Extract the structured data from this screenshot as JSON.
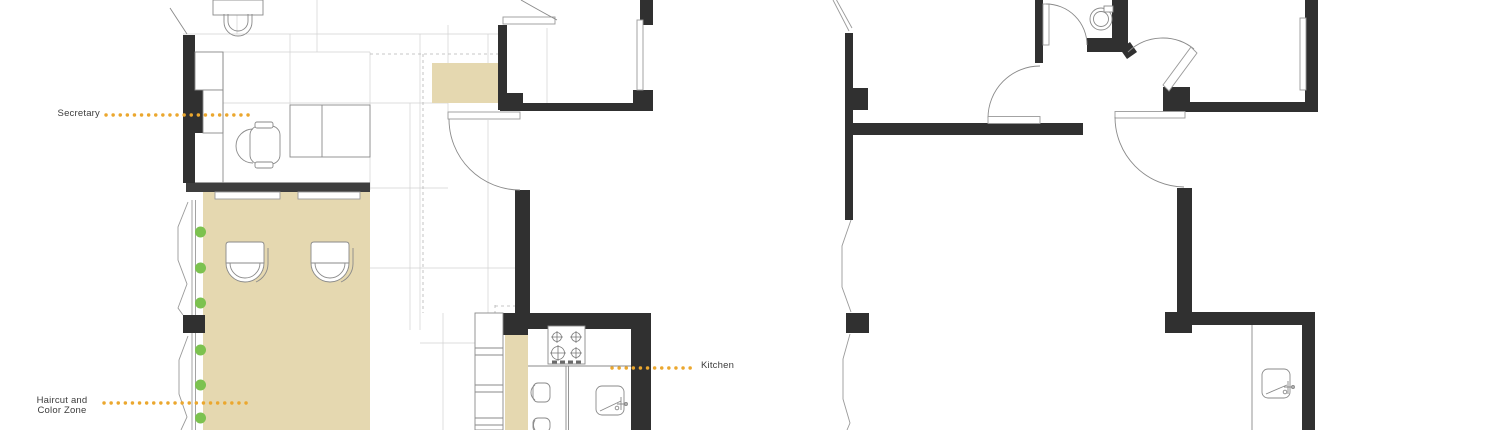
{
  "canvas": {
    "width": 1500,
    "height": 430,
    "background": "#ffffff"
  },
  "labels": {
    "secretary": {
      "text": "Secretary"
    },
    "haircut_color_zone": {
      "line1": "Haircut and",
      "line2": "Color Zone"
    },
    "kitchen": {
      "text": "Kitchen"
    }
  },
  "annotations": {
    "leader_line_style": "dotted",
    "leader_line_color": "#eba72e",
    "green_marker_dots_count": 6
  },
  "colors": {
    "wall": "#303030",
    "partition_band": "#3e3e3e",
    "zone_fill_tan": "#e5d8b0",
    "marker_green": "#7cc24f",
    "furniture_line": "#8a8a8a",
    "window_line": "#9a9a9a",
    "grid_line": "#d2d2d2",
    "label_text": "#3c3c3c"
  },
  "plans": {
    "left": {
      "id": "plan-left",
      "zones": [
        "Secretary",
        "Haircut and Color Zone",
        "Kitchen"
      ]
    },
    "right": {
      "id": "plan-right",
      "zones": []
    }
  }
}
